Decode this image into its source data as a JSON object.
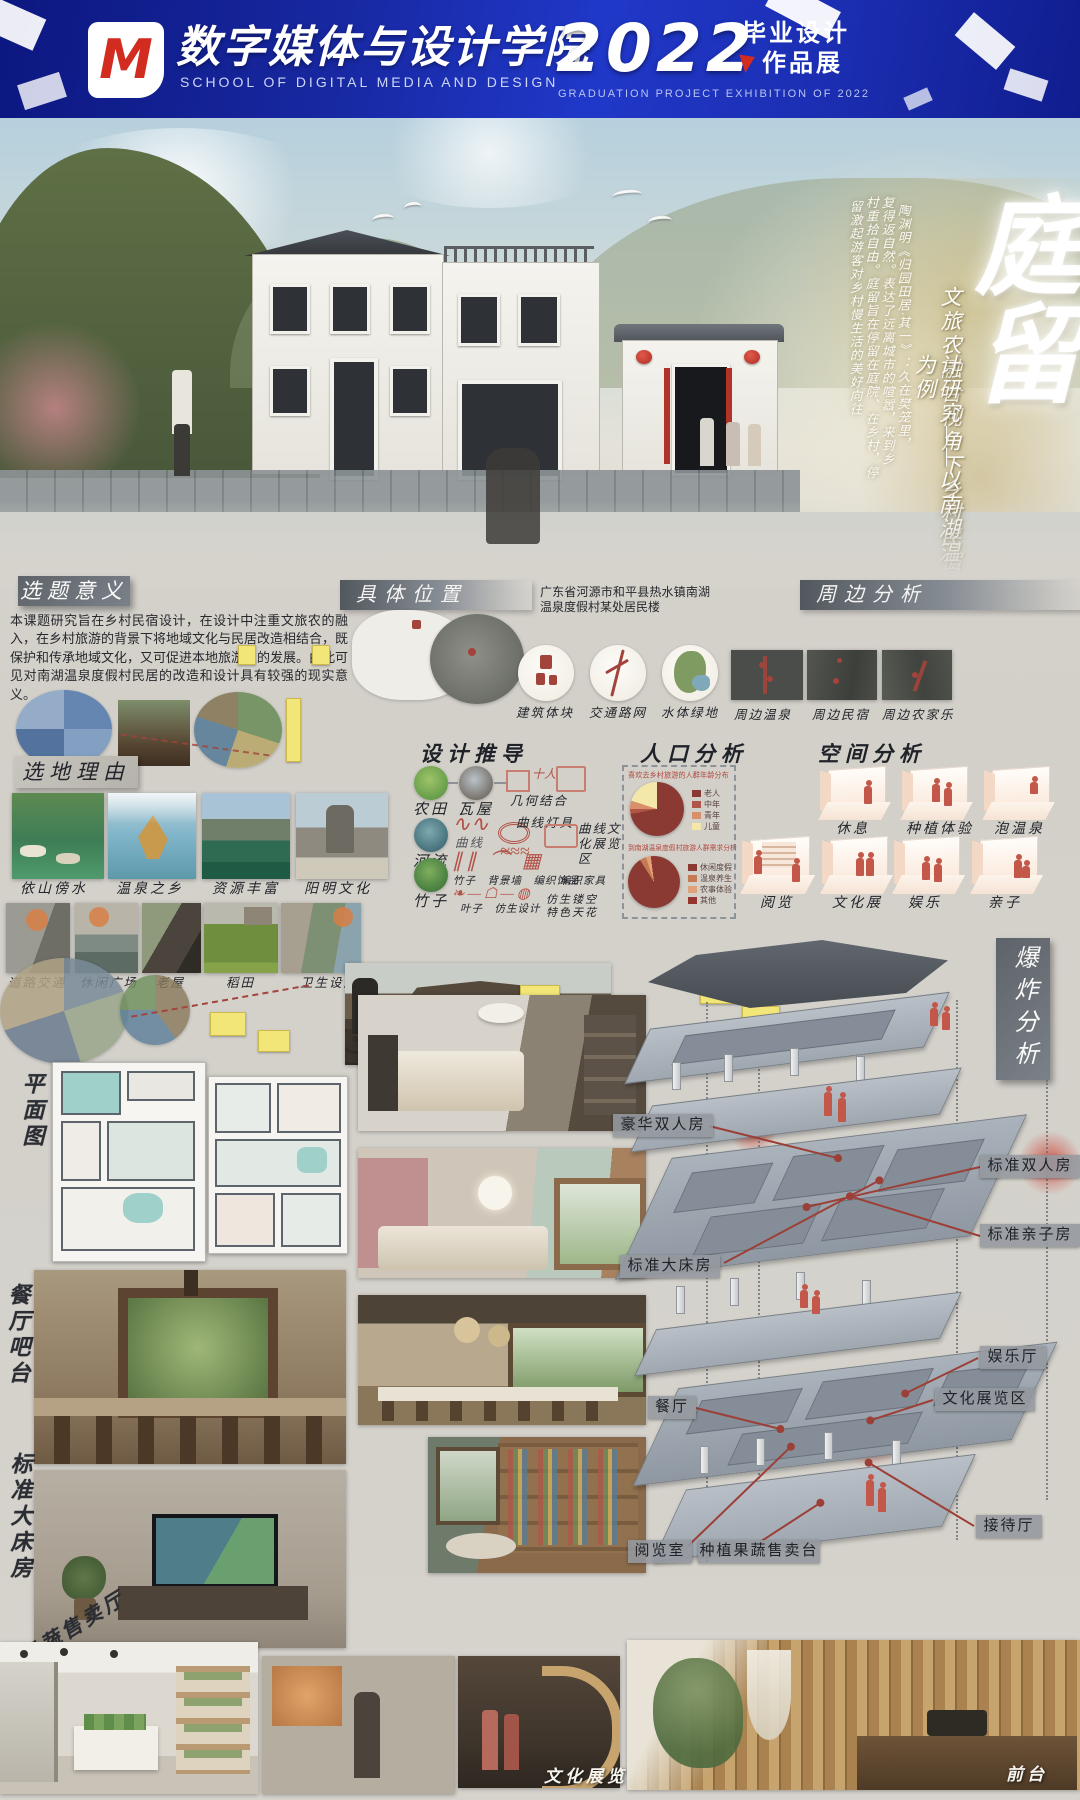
{
  "header": {
    "logo_letter": "M",
    "school_cn": "数字媒体与设计学院",
    "school_en": "SCHOOL OF DIGITAL MEDIA AND DESIGN",
    "year": "2022",
    "program_line1": "毕业设计",
    "program_line2": "作品展",
    "exhibition_en": "GRADUATION PROJECT EXHIBITION OF 2022"
  },
  "hero": {
    "title": "庭留",
    "subtitle_col1": "文旅农融合视角下乡村民宿设",
    "subtitle_col2": "计研究——以南湖温泉度假村为例",
    "poem_col1": "陶渊明《归园田居·其一》：久在樊笼里，",
    "poem_col2": "复得返自然。表达了远离城市的喧嚣，来到乡",
    "poem_col3": "村重拾自由。庭留旨在停留在庭院、在乡村，停",
    "poem_col4": "留激起游客对乡村慢生活的美好向往"
  },
  "significance": {
    "heading": "选题意义",
    "body": "本课题研究旨在乡村民宿设计，在设计中注重文旅农的融入，在乡村旅游的背景下将地域文化与民居改造相结合，既保护和传承地域文化，又可促进本地旅游业的发展。由此可见对南湖温泉度假村民居的改造和设计具有较强的现实意义。"
  },
  "location": {
    "heading": "具体位置",
    "address": "广东省河源市和平县热水镇南湖温泉度假村某处居民楼"
  },
  "surroundings": {
    "heading": "周边分析",
    "diagrams": [
      {
        "label": "建筑体块"
      },
      {
        "label": "交通路网"
      },
      {
        "label": "水体绿地"
      }
    ],
    "photos": [
      {
        "label": "周边温泉"
      },
      {
        "label": "周边民宿"
      },
      {
        "label": "周边农家乐"
      }
    ]
  },
  "site_reasons": {
    "heading": "选地理由",
    "features": [
      {
        "label": "依山傍水"
      },
      {
        "label": "温泉之乡"
      },
      {
        "label": "资源丰富"
      },
      {
        "label": "阳明文化"
      }
    ],
    "facilities": [
      {
        "label": "道路交通"
      },
      {
        "label": "休闲广场"
      },
      {
        "label": "老屋"
      },
      {
        "label": "稻田"
      },
      {
        "label": "卫生设施"
      }
    ]
  },
  "derivation": {
    "heading": "设计推导",
    "farmland": "农田",
    "tile_house": "瓦屋",
    "geometry": "几何结合",
    "river": "河流",
    "curve": "曲线",
    "curve_lamp": "曲线灯具",
    "curve_exhibition": "曲线文化展览区",
    "bamboo": "竹子",
    "bamboo_row": "竹子　背景墙　编织饰品",
    "weave_furniture": "编织家具",
    "leaf_row": "叶子　仿生设计",
    "bionic_ceiling": "仿生镂空特色天花"
  },
  "population": {
    "heading": "人口分析"
  },
  "space_analysis": {
    "heading": "空间分析",
    "rooms": [
      {
        "label": "休息"
      },
      {
        "label": "种植体验"
      },
      {
        "label": "泡温泉"
      },
      {
        "label": "阅览"
      },
      {
        "label": "文化展"
      },
      {
        "label": "娱乐"
      },
      {
        "label": "亲子"
      }
    ]
  },
  "floor_plan": {
    "heading": "平面图"
  },
  "bar_area": {
    "heading": "餐厅吧台"
  },
  "king_room": {
    "heading": "标准大床房"
  },
  "explosion": {
    "heading": "爆炸分析",
    "labels": [
      {
        "text": "豪华双人房"
      },
      {
        "text": "标准双人房"
      },
      {
        "text": "标准亲子房"
      },
      {
        "text": "标准大床房"
      },
      {
        "text": "娱乐厅"
      },
      {
        "text": "文化展览区"
      },
      {
        "text": "餐厅"
      },
      {
        "text": "接待厅"
      },
      {
        "text": "阅览室"
      },
      {
        "text": "种植果蔬售卖台"
      }
    ]
  },
  "bottom": {
    "produce_shop": "果蔬售卖厅",
    "culture_zone": "文化展览区",
    "front_desk": "前台"
  },
  "colors": {
    "header_blue": "#1b2bb8",
    "accent_red": "#a2443b",
    "pie_dark_red": "#8a3a33",
    "pie_yellow": "#f3e7a9",
    "bar_gray": "#6b7077",
    "room_pink": "#f3d8c5",
    "figure_red": "#c2574a"
  },
  "chart_data": [
    {
      "type": "pie",
      "title": "喜欢去乡村旅游的人群年龄分布",
      "labels": [
        "老人",
        "中年",
        "青年",
        "儿童"
      ],
      "values": [
        72,
        3,
        5,
        20
      ],
      "colors": [
        "#8a3a33",
        "#b05648",
        "#d88f6a",
        "#f3e7a9"
      ],
      "legend_position": "right"
    },
    {
      "type": "pie",
      "title": "到南湖温泉度假村旅游人群需求分析",
      "labels": [
        "休闲度假",
        "温泉养生",
        "农事体验",
        "其他"
      ],
      "values": [
        91,
        4,
        3,
        2
      ],
      "colors": [
        "#8a3a33",
        "#c47a52",
        "#e0a379",
        "#96352e"
      ],
      "legend_position": "right"
    }
  ]
}
